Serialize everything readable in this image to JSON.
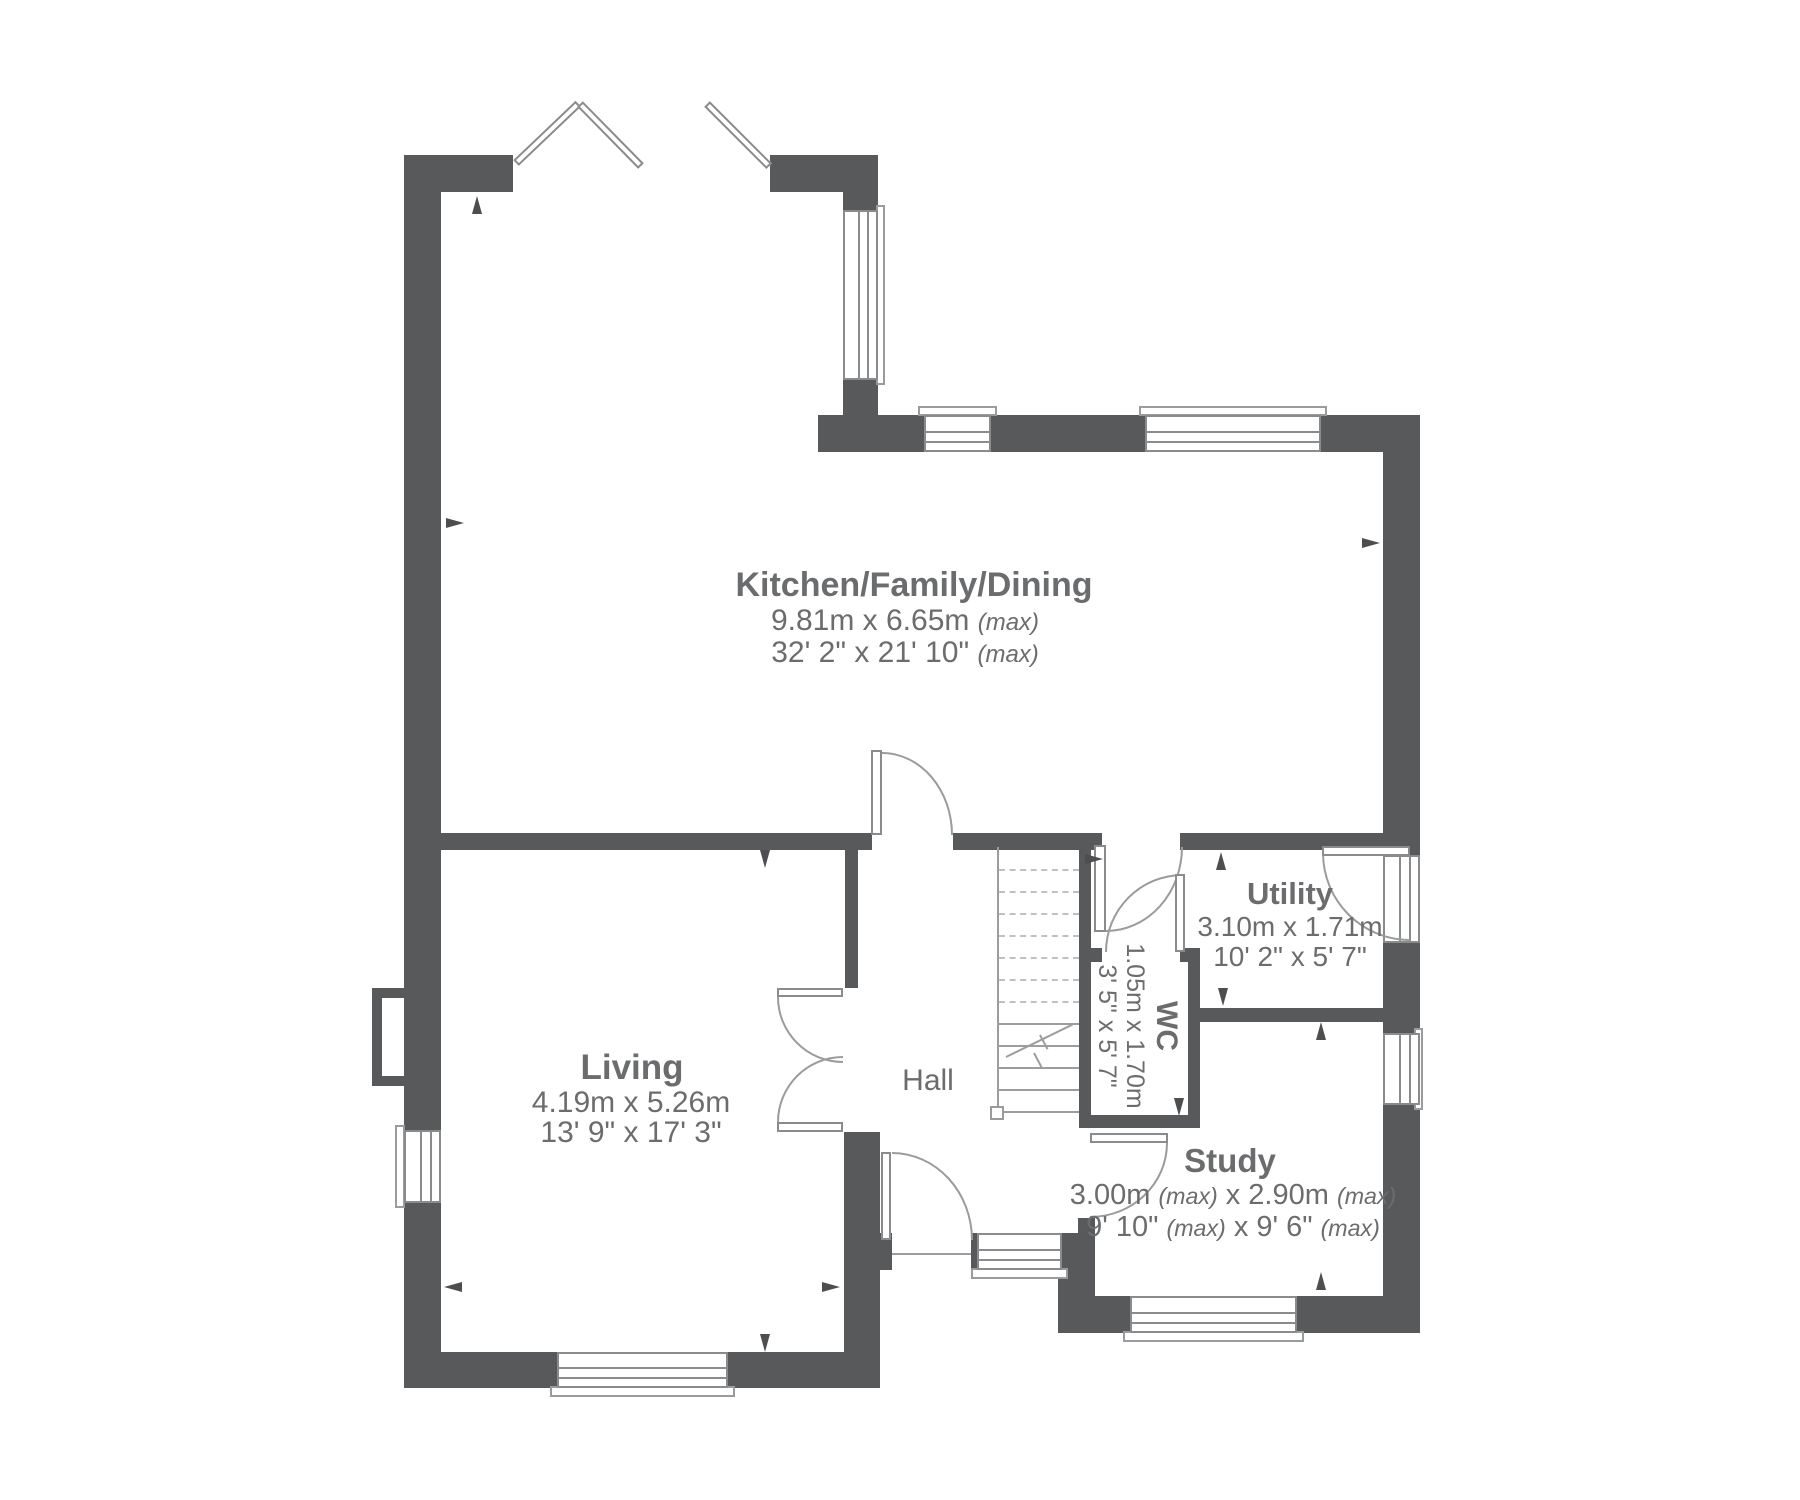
{
  "rooms": {
    "kitchen": {
      "name": "Kitchen/Family/Dining",
      "metric": "9.81m x 6.65m",
      "metric_max": "(max)",
      "imperial": "32' 2\" x 21' 10\"",
      "imperial_max": "(max)"
    },
    "living": {
      "name": "Living",
      "metric": "4.19m x 5.26m",
      "imperial": "13' 9\" x 17' 3\""
    },
    "hall": {
      "name": "Hall"
    },
    "utility": {
      "name": "Utility",
      "metric": "3.10m x 1.71m",
      "imperial": "10' 2\" x 5' 7\""
    },
    "wc": {
      "name": "WC",
      "metric": "1.05m x 1.70m",
      "imperial": "3' 5\" x 5' 7\""
    },
    "study": {
      "name": "Study",
      "metric_a": "3.00m",
      "metric_max_a": "(max)",
      "metric_b": "x 2.90m",
      "metric_max_b": "(max)",
      "imperial_a": "9' 10\"",
      "imperial_max_a": "(max)",
      "imperial_b": "x 9' 6\"",
      "imperial_max_b": "(max)"
    }
  },
  "colors": {
    "wall": "#58595b",
    "text": "#6b6c6e",
    "line": "#9a9b9d"
  }
}
